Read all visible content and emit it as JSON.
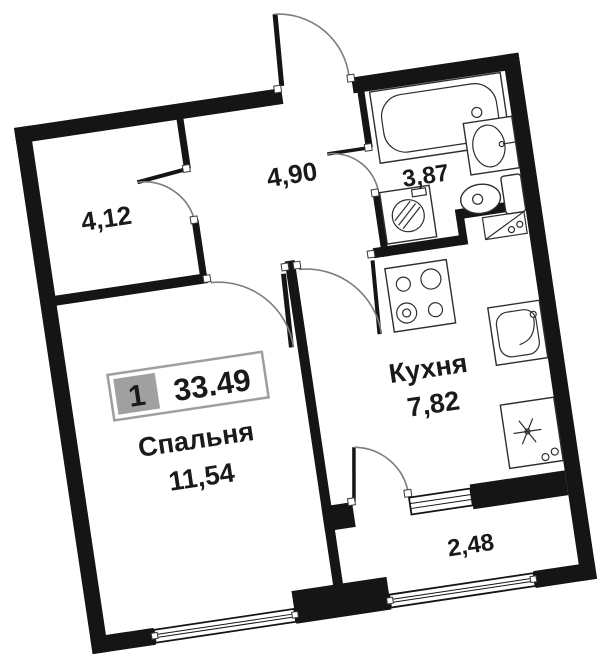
{
  "plan": {
    "type": "apartment-floor-plan",
    "rotation_deg": -8.5,
    "unit_badge": {
      "number": "1",
      "total_area": "33.49"
    },
    "rooms": [
      {
        "key": "hallway",
        "area": "4,12"
      },
      {
        "key": "corridor",
        "area": "4,90"
      },
      {
        "key": "bathroom",
        "area": "3,87"
      },
      {
        "key": "kitchen",
        "name": "Кухня",
        "area": "7,82"
      },
      {
        "key": "bedroom",
        "name": "Спальня",
        "area": "11,54"
      },
      {
        "key": "balcony",
        "area": "2,48"
      }
    ],
    "colors": {
      "wall": "#151515",
      "text": "#1a1a1a",
      "badge_cell": "#a0a0a0",
      "badge_border": "#9e9e9e",
      "door_arc": "#7d7d7d"
    }
  }
}
